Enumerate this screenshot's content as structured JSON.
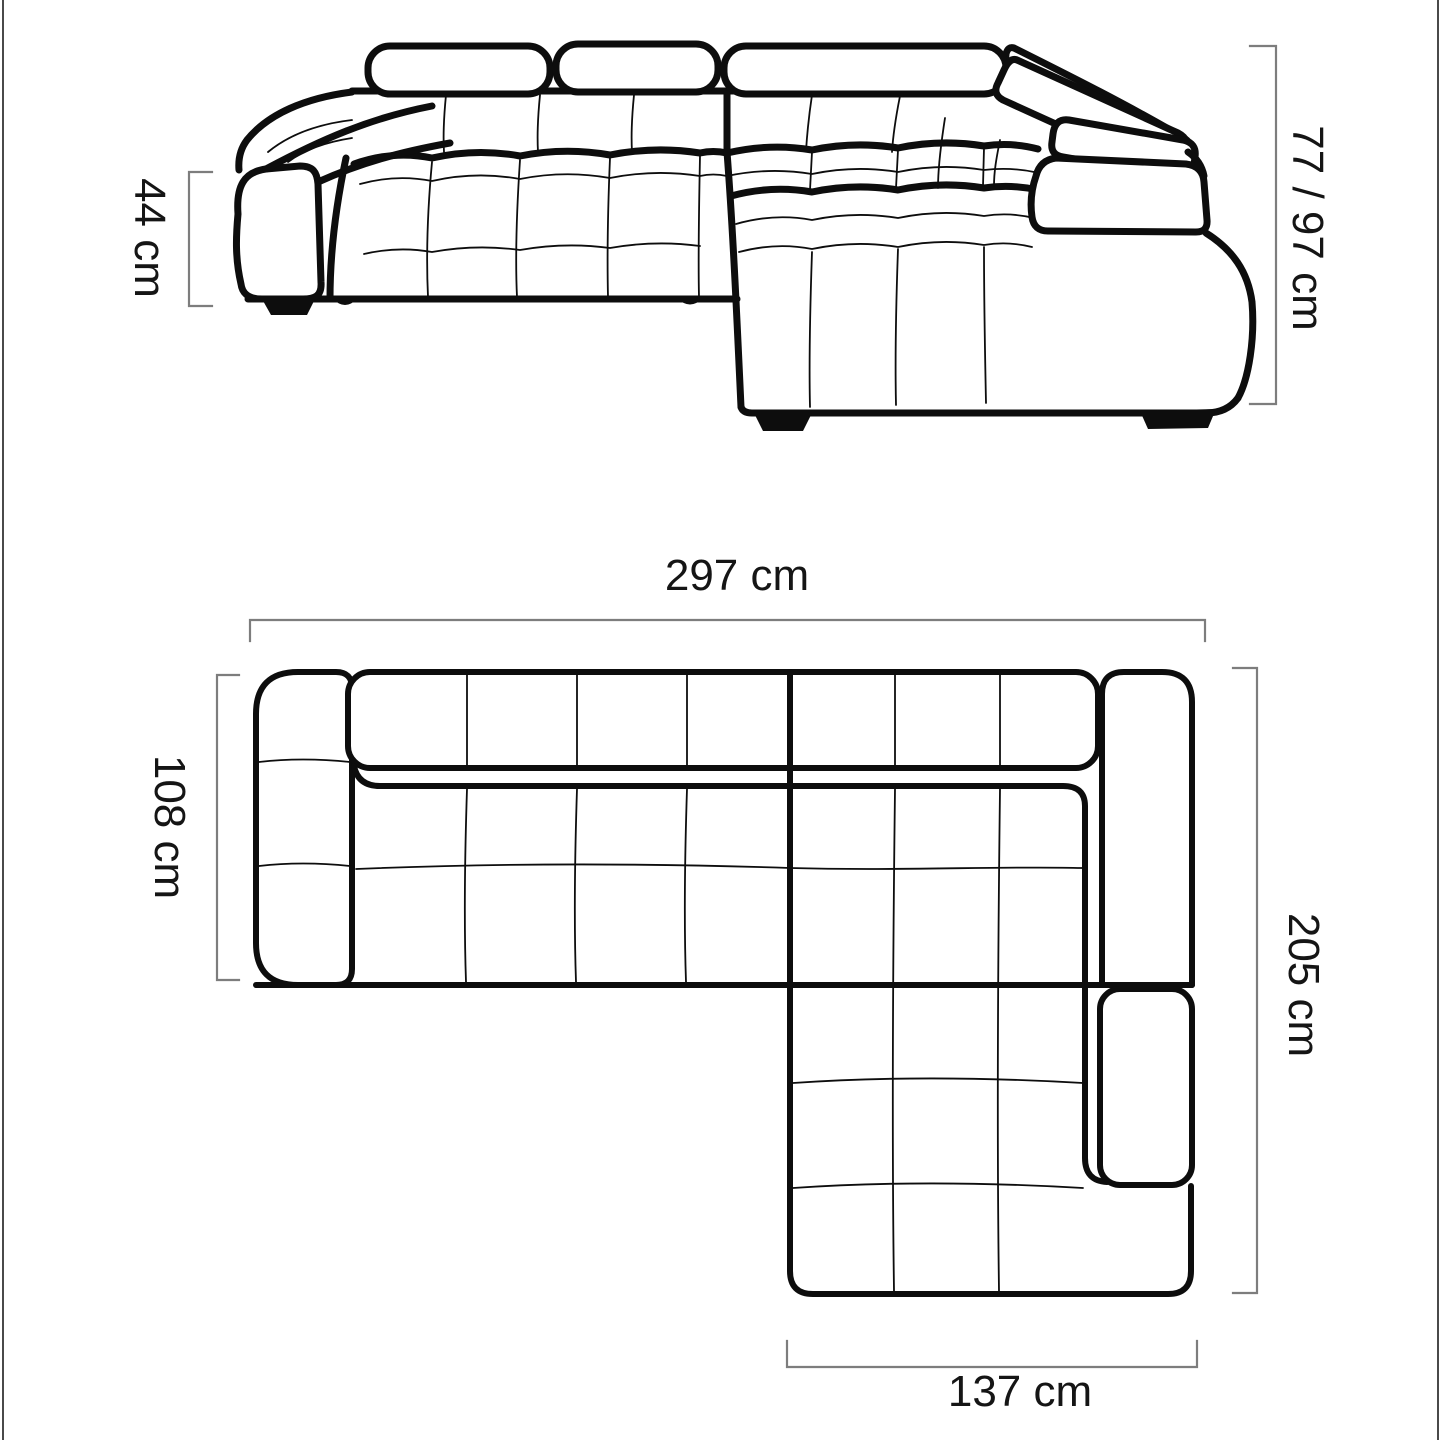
{
  "page": {
    "background": "#ffffff",
    "frame_edge_color": "#4a4a4a"
  },
  "diagram": {
    "subject": "corner-sofa-dimension-drawing",
    "views": [
      "front-perspective-view",
      "top-plan-view"
    ],
    "colors": {
      "sofa_line": "#0d0d0d",
      "dimension_line": "#7d7d7d",
      "label_text": "#151515",
      "feet_fill": "#0d0d0d"
    },
    "labels": {
      "seat_height": "44 cm",
      "back_height": "77 / 97 cm",
      "total_width": "297 cm",
      "seat_depth": "108 cm",
      "total_depth": "205 cm",
      "chaise_width": "137 cm"
    }
  }
}
